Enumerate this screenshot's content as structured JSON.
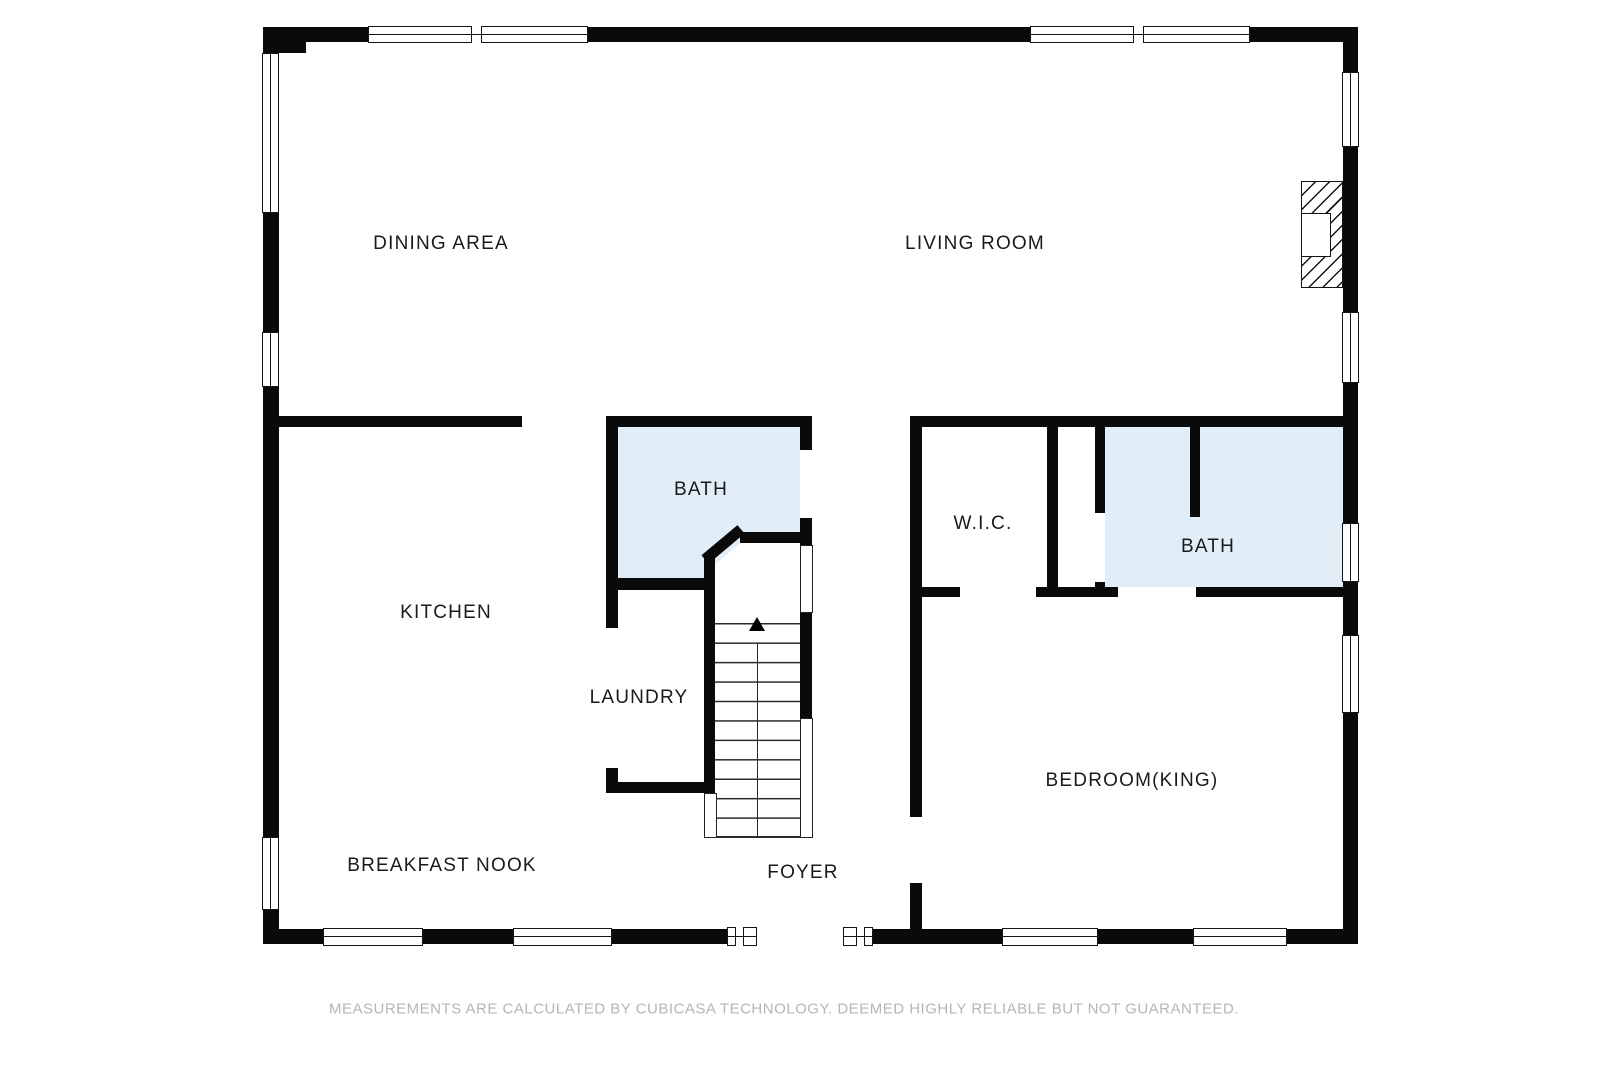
{
  "colors": {
    "wall": "#0a0a0a",
    "bath_fill": "#e1eef8",
    "label": "#1a1a1a",
    "disclaimer": "#b5b5b5"
  },
  "rooms": {
    "dining_area": "DINING AREA",
    "living_room": "LIVING ROOM",
    "kitchen": "KITCHEN",
    "bath_center": "BATH",
    "wic": "W.I.C.",
    "bath_right": "BATH",
    "laundry": "LAUNDRY",
    "bedroom": "BEDROOM(KING)",
    "breakfast_nook": "BREAKFAST NOOK",
    "foyer": "FOYER"
  },
  "stairs": {
    "direction": "up"
  },
  "disclaimer": "MEASUREMENTS ARE CALCULATED BY CUBICASA TECHNOLOGY. DEEMED HIGHLY RELIABLE BUT NOT GUARANTEED."
}
